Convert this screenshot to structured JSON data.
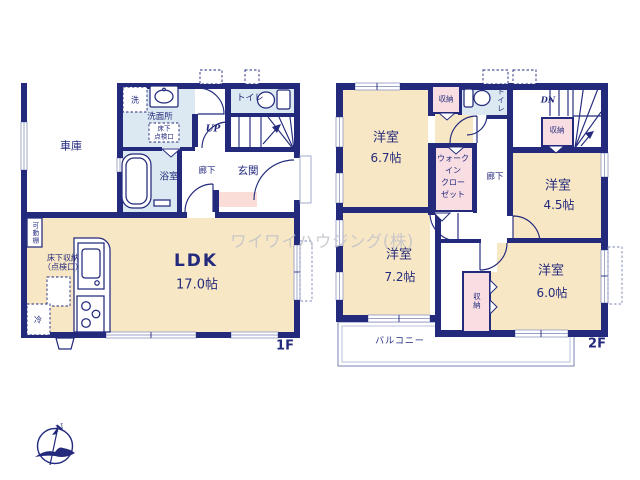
{
  "title": "floor-plan",
  "watermark": "ワイワイハウジング(株)",
  "compass": {
    "north": "N"
  },
  "floor1": {
    "name": "1F",
    "garage": "車庫",
    "washer": "洗",
    "washroom": "洗面所",
    "underfloor_hatch": "床下\n点検口",
    "toilet": "トイレ",
    "up": "UP",
    "bathroom": "浴室",
    "hallway": "廊下",
    "entrance": "玄関",
    "movable_shelf": "可動棚",
    "underfloor_storage": "床下収納\n（点検口）",
    "fridge": "冷",
    "ldk": "LDK",
    "ldk_size": "17.0帖"
  },
  "floor2": {
    "name": "2F",
    "bedroom_67": "洋室",
    "bedroom_67_size": "6.7帖",
    "closet_upper": "収納",
    "toilet": "トイレ",
    "dn": "DN",
    "closet_stair": "収納",
    "hallway": "廊下",
    "bedroom_45": "洋室",
    "bedroom_45_size": "4.5帖",
    "walk_in_closet": "ウォーク\nイン\nクロー\nゼット",
    "bedroom_72": "洋室",
    "bedroom_72_size": "7.2帖",
    "bedroom_60": "洋室",
    "bedroom_60_size": "6.0帖",
    "closet_lower": "収納",
    "balcony": "バルコニー"
  },
  "colors": {
    "wall": "#232a7c",
    "room": "#f7e7c5",
    "wet_area": "#dce9f2",
    "closet": "#f8dde2",
    "entry_step": "#f9ddd6",
    "window": "#99a1c5",
    "watermark": "#c2c2c8"
  }
}
